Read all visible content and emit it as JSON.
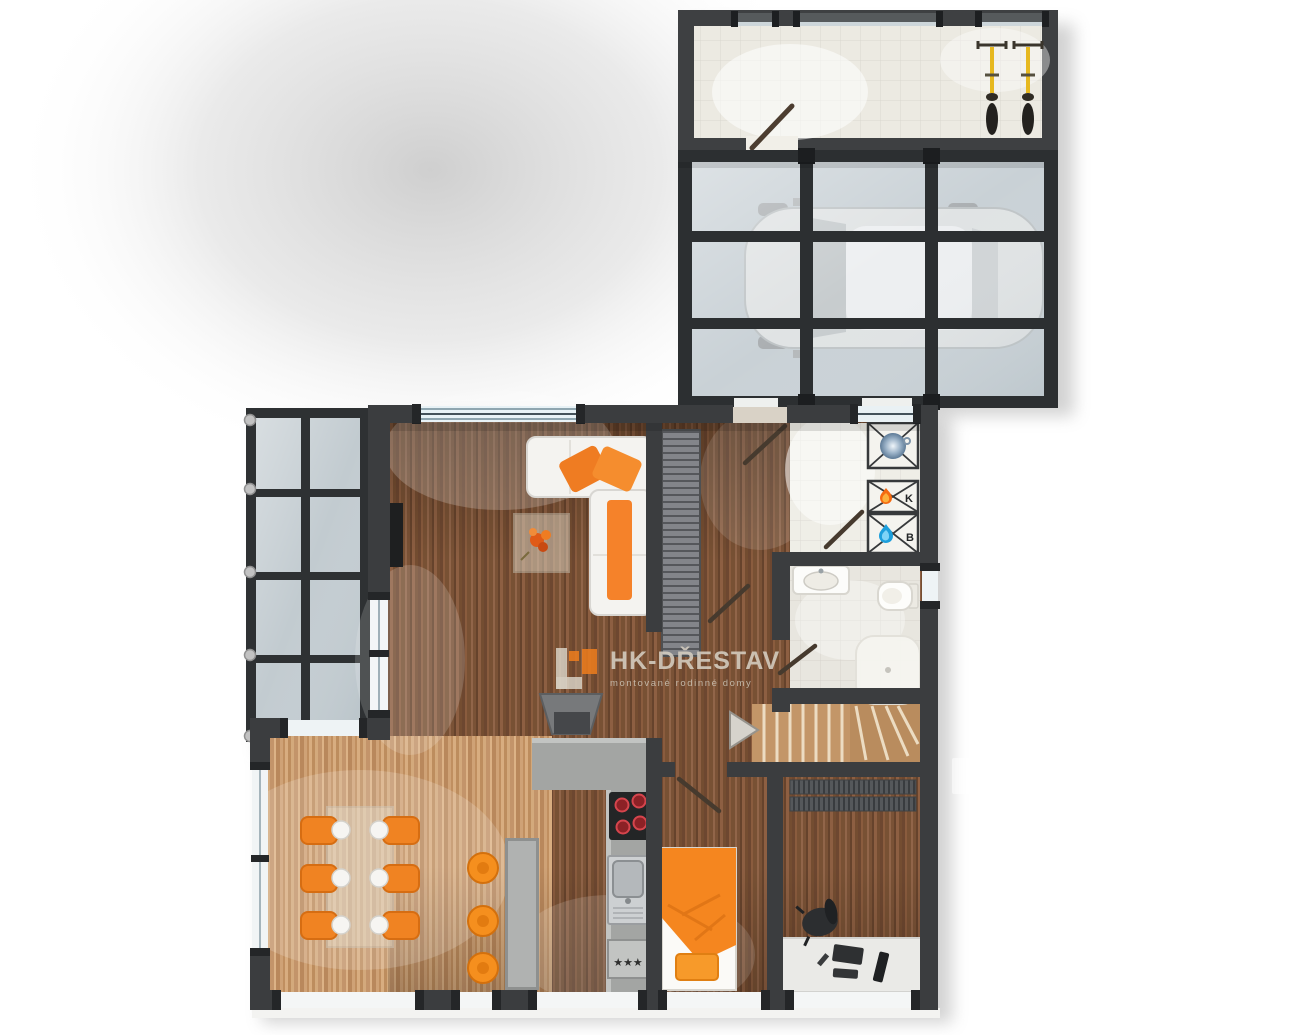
{
  "watermark": {
    "brand": "HK-DŘESTAV",
    "tagline": "montované rodinné domy"
  },
  "equipment_labels": {
    "boiler": "K",
    "water_heater": "B",
    "freezer_rating": "★★★"
  },
  "palette": {
    "accent_orange": "#f08020",
    "wall_dark": "#3b3d3f",
    "wood_dark": "#7c5336",
    "wood_light": "#c99c6e",
    "glass_blue": "#bfc9ce",
    "tile_floor": "#efeee7"
  },
  "icons": [
    {
      "name": "flame-icon",
      "meaning": "boiler K"
    },
    {
      "name": "drop-icon",
      "meaning": "water heater B"
    },
    {
      "name": "sphere-icon",
      "meaning": "washing machine"
    },
    {
      "name": "stairs-arrow-icon",
      "meaning": "stairs direction"
    },
    {
      "name": "bicycle-icon",
      "meaning": "bike storage"
    }
  ]
}
